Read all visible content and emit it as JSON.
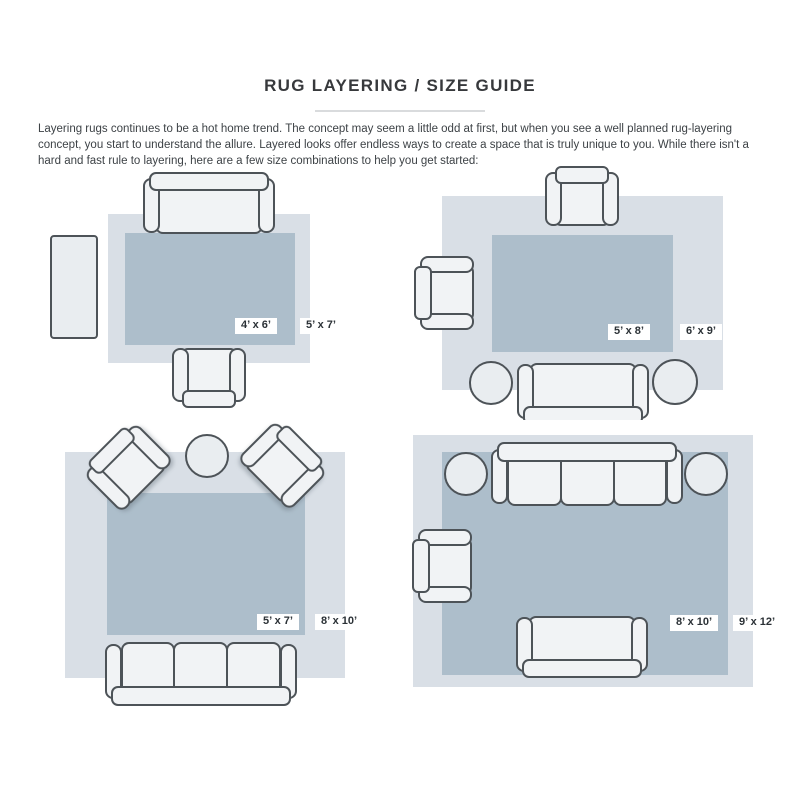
{
  "page": {
    "title": "RUG LAYERING / SIZE GUIDE",
    "intro": "Layering rugs continues to be a hot home trend. The concept may seem a little odd at first, but when you see a well planned rug-layering concept, you start to understand the allure. Layered looks offer endless ways to create a space that is truly unique to you. While there isn't a hard and fast rule to layering, here are a few size combinations to help you get started:"
  },
  "colors": {
    "page_bg": "#ffffff",
    "title_text": "#37393c",
    "body_text": "#3d4246",
    "divider": "#d9dbdd",
    "rug_outer": "#d9dfe6",
    "rug_inner": "#adbecb",
    "furniture_fill": "#f1f3f5",
    "furniture_stroke": "#4d5358",
    "table_fill": "#e9edf0",
    "label_bg": "#ffffff",
    "label_text": "#2b3136"
  },
  "rooms": [
    {
      "furniture": [
        "sofa",
        "armchair",
        "side-table"
      ],
      "inner_rug_label": "4’ x 6’",
      "outer_rug_label": "5’ x 7’"
    },
    {
      "furniture": [
        "armchair",
        "armchair",
        "sofa",
        "round-table",
        "round-table"
      ],
      "inner_rug_label": "5’ x 8’",
      "outer_rug_label": "6’ x 9’"
    },
    {
      "furniture": [
        "armchair",
        "armchair",
        "round-table",
        "three-seat-sofa"
      ],
      "inner_rug_label": "5’ x 7’",
      "outer_rug_label": "8’ x 10’"
    },
    {
      "furniture": [
        "three-seat-sofa",
        "round-table",
        "round-table",
        "armchair",
        "loveseat"
      ],
      "inner_rug_label": "8’ x 10’",
      "outer_rug_label": "9’ x 12’"
    }
  ]
}
